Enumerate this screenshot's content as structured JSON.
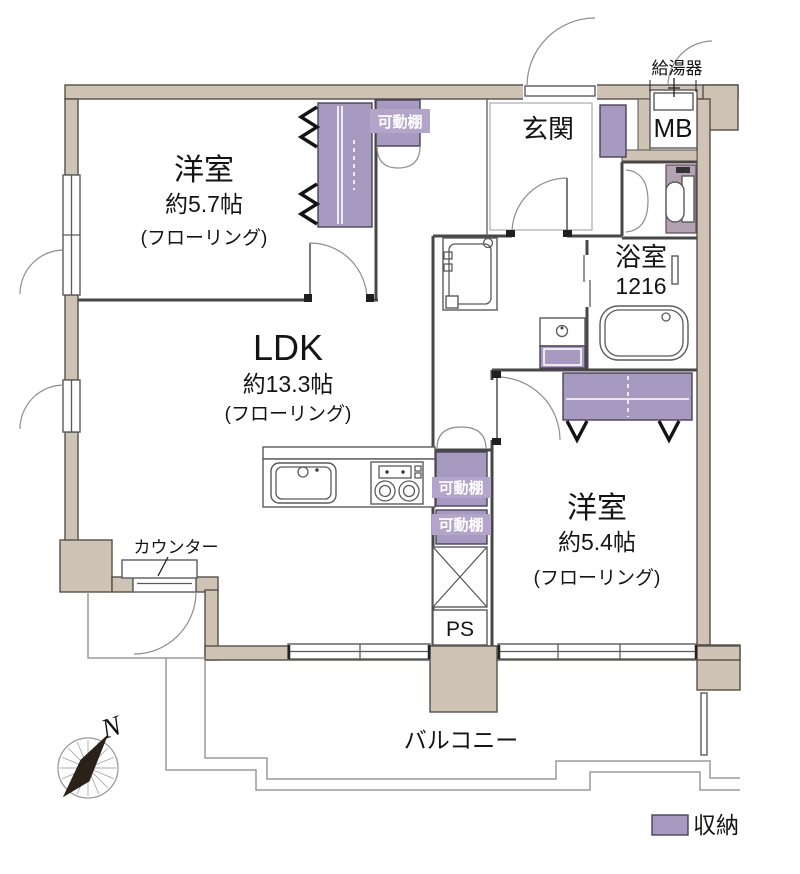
{
  "colors": {
    "wall": "#cfc3b6",
    "storage": "#a79ac1",
    "storage_label_bg": "#b2a5c9",
    "toilet": "#b3a1b4"
  },
  "rooms": {
    "bedroom1": {
      "name": "洋室",
      "size": "約5.7帖",
      "floor": "(フローリング)"
    },
    "ldk": {
      "name": "LDK",
      "size": "約13.3帖",
      "floor": "(フローリング)"
    },
    "bedroom2": {
      "name": "洋室",
      "size": "約5.4帖",
      "floor": "(フローリング)"
    },
    "entrance": {
      "name": "玄関"
    },
    "bathroom": {
      "name": "浴室",
      "size": "1216"
    },
    "balcony": {
      "name": "バルコニー"
    }
  },
  "labels": {
    "water_heater": "給湯器",
    "meter_box": "MB",
    "pipe_space": "PS",
    "counter": "カウンター",
    "movable_shelf_1": "可動棚",
    "movable_shelf_2": "可動棚",
    "movable_shelf_3": "可動棚",
    "compass_north": "N"
  },
  "legend": {
    "storage": "収納"
  }
}
